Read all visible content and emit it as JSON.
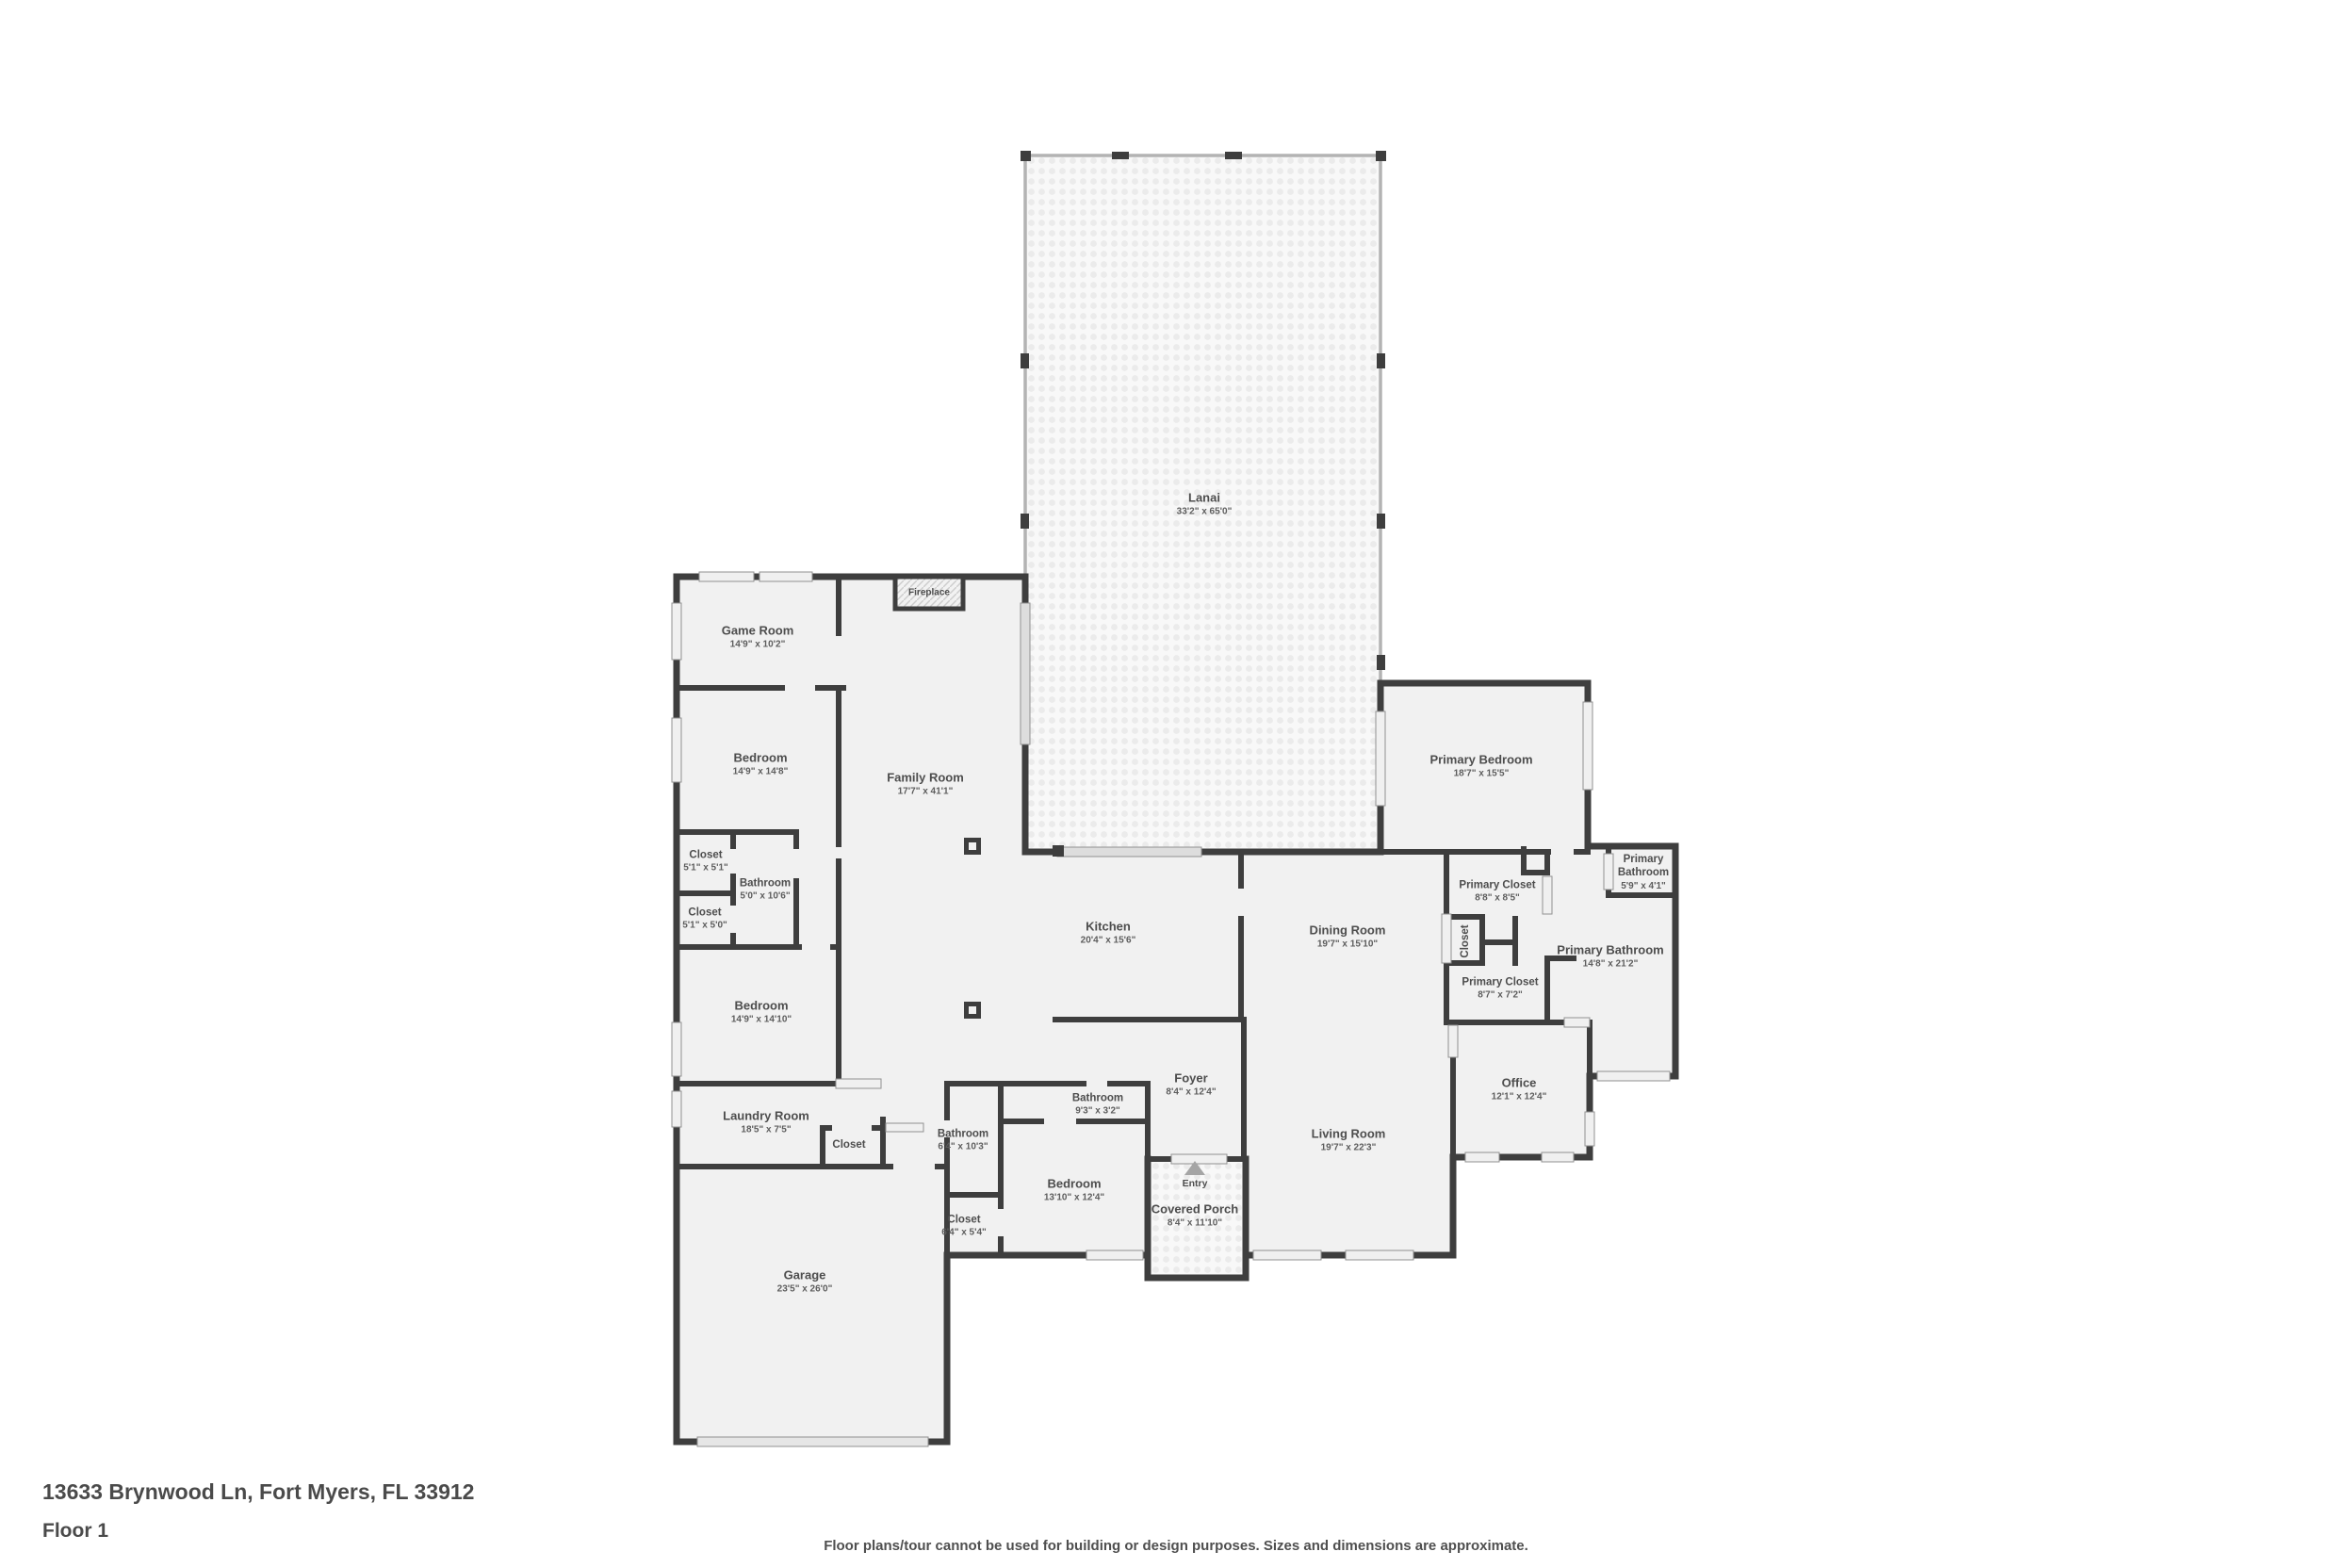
{
  "footer": {
    "address": "13633 Brynwood Ln, Fort Myers, FL 33912",
    "floor_label": "Floor 1",
    "disclaimer": "Floor plans/tour cannot be used for building or design purposes. Sizes and dimensions are approximate."
  },
  "colors": {
    "wall": "#3e3e3e",
    "floor": "#f1f1f1",
    "window": "#f0f0f0",
    "screen": "#b3b3b3",
    "label_text": "#4d4d4d"
  },
  "features": {
    "fireplace": "Fireplace",
    "entry": "Entry",
    "entry_arrow": "up-triangle"
  },
  "rooms": {
    "lanai": {
      "name": "Lanai",
      "dims": "33'2\" x 65'0\""
    },
    "game_room": {
      "name": "Game Room",
      "dims": "14'9\" x 10'2\""
    },
    "family_room": {
      "name": "Family Room",
      "dims": "17'7\" x 41'1\""
    },
    "bedroom1": {
      "name": "Bedroom",
      "dims": "14'9\" x 14'8\""
    },
    "closet1": {
      "name": "Closet",
      "dims": "5'1\" x 5'1\""
    },
    "bathroom1": {
      "name": "Bathroom",
      "dims": "5'0\" x 10'6\""
    },
    "closet2": {
      "name": "Closet",
      "dims": "5'1\" x 5'0\""
    },
    "bedroom2": {
      "name": "Bedroom",
      "dims": "14'9\" x 14'10\""
    },
    "laundry": {
      "name": "Laundry Room",
      "dims": "18'5\" x 7'5\""
    },
    "laundry_closet": {
      "name": "Closet"
    },
    "garage": {
      "name": "Garage",
      "dims": "23'5\" x 26'0\""
    },
    "kitchen": {
      "name": "Kitchen",
      "dims": "20'4\" x 15'6\""
    },
    "dining": {
      "name": "Dining Room",
      "dims": "19'7\" x 15'10\""
    },
    "bathroom3": {
      "name": "Bathroom",
      "dims": "6'4\" x 10'3\""
    },
    "closet3": {
      "name": "Closet",
      "dims": "6'4\" x 5'4\""
    },
    "bedroom3": {
      "name": "Bedroom",
      "dims": "13'10\" x 12'4\""
    },
    "bathroom2": {
      "name": "Bathroom",
      "dims": "9'3\" x 3'2\""
    },
    "foyer": {
      "name": "Foyer",
      "dims": "8'4\" x 12'4\""
    },
    "covered_porch": {
      "name": "Covered Porch",
      "dims": "8'4\" x 11'10\""
    },
    "living": {
      "name": "Living Room",
      "dims": "19'7\" x 22'3\""
    },
    "office": {
      "name": "Office",
      "dims": "12'1\" x 12'4\""
    },
    "primary_bedroom": {
      "name": "Primary Bedroom",
      "dims": "18'7\" x 15'5\""
    },
    "primary_closet1": {
      "name": "Primary Closet",
      "dims": "8'8\" x 8'5\""
    },
    "primary_bath_small": {
      "name": "Primary Bathroom",
      "dims": "5'9\" x 4'1\""
    },
    "hall_closet": {
      "name": "Closet"
    },
    "primary_bath_big": {
      "name": "Primary Bathroom",
      "dims": "14'8\" x 21'2\""
    },
    "primary_closet2": {
      "name": "Primary Closet",
      "dims": "8'7\" x 7'2\""
    }
  }
}
